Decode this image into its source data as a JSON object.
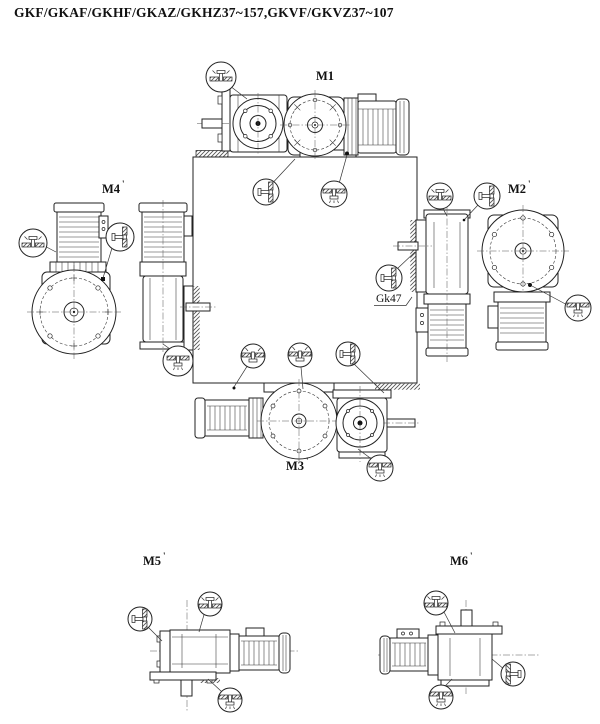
{
  "page": {
    "title": "GKF/GKAF/GKHF/GKAZ/GKHZ37~157,GKVF/GKVZ37~107",
    "background_color": "#ffffff",
    "line_color": "#222222"
  },
  "mounting_positions": [
    {
      "id": "M1",
      "label": "M1",
      "mark": ""
    },
    {
      "id": "M2",
      "label": "M2",
      "mark": "'"
    },
    {
      "id": "M3",
      "label": "M3",
      "mark": "'"
    },
    {
      "id": "M4",
      "label": "M4",
      "mark": "'"
    },
    {
      "id": "M5",
      "label": "M5",
      "mark": "'"
    },
    {
      "id": "M6",
      "label": "M6",
      "mark": "'"
    }
  ],
  "annotations": {
    "gk47_label": "Gk47"
  },
  "icons": {
    "vent_plug": "vent-plug-icon",
    "oil_level_plug": "oil-level-plug-icon",
    "oil_drain_plug": "oil-drain-plug-icon"
  }
}
